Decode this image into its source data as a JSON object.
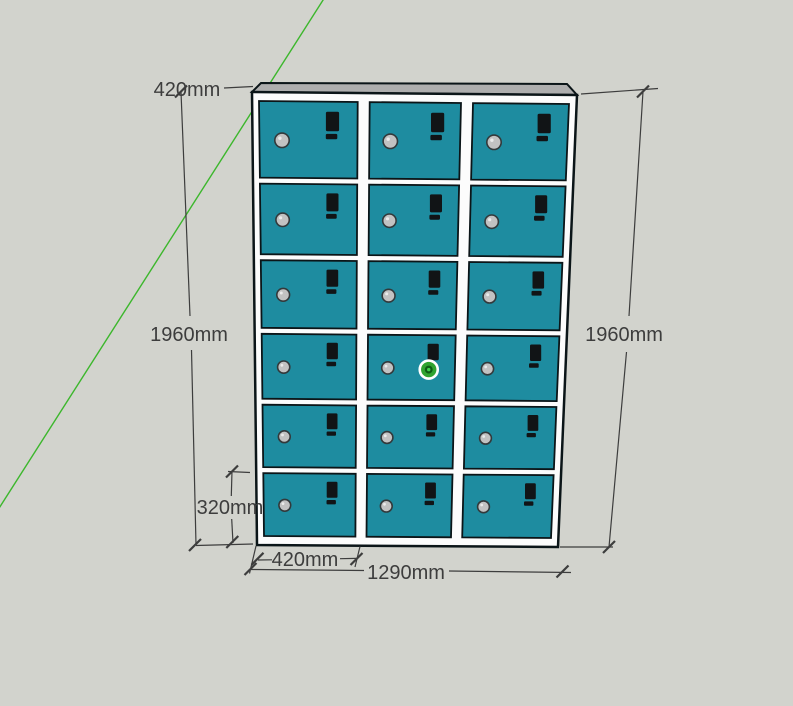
{
  "viewport": {
    "width": 793,
    "height": 706,
    "background_color": "#d2d3cd"
  },
  "axis": {
    "green_axis_color": "#3cb72c"
  },
  "cabinet": {
    "rows": 6,
    "columns": 3,
    "door_count": 18,
    "door_color": "#1e8ca0",
    "frame_color": "#fcfcfc",
    "outline_color": "#0b1518",
    "top_face_color": "#aeaeae",
    "knob_color": "#c2c2c2",
    "handle_color": "#111416"
  },
  "selection_marker": {
    "row": 4,
    "column": 2,
    "ring_color": "#2fa330",
    "core_color": "#0d5a15",
    "dot_color": "#3ed14a",
    "halo_color": "#ffffff"
  },
  "dimensions": {
    "style_color": "#3d3d3d",
    "top_depth": "420mm",
    "left_height": "1960mm",
    "right_height": "1960mm",
    "bottom_compartment_height": "320mm",
    "door_width": "420mm",
    "total_width": "1290mm"
  }
}
